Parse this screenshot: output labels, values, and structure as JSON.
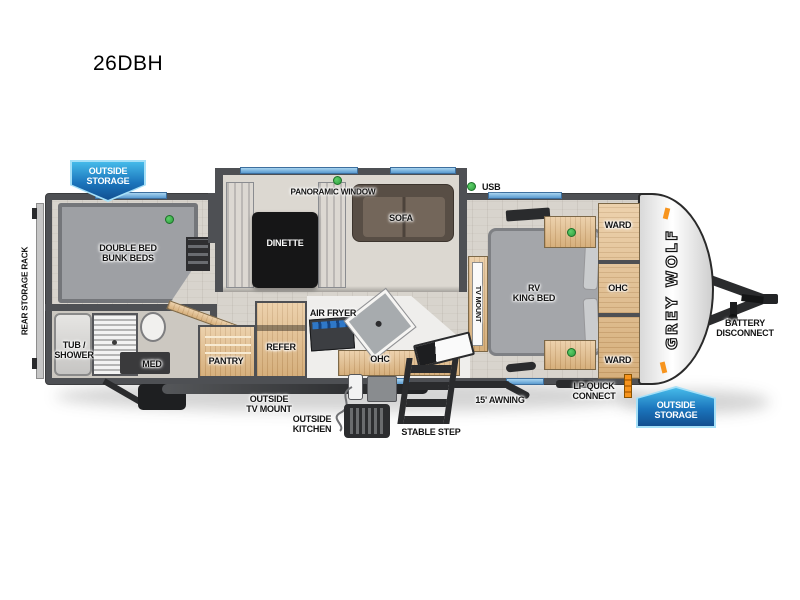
{
  "title": "26DBH",
  "brand": "GREY WOLF",
  "legend": {
    "usb": "USB"
  },
  "exterior": {
    "rear_storage_rack": "REAR STORAGE RACK",
    "outside_storage_rear": "OUTSIDE\nSTORAGE",
    "outside_storage_front": "OUTSIDE\nSTORAGE",
    "battery_disconnect": "BATTERY\nDISCONNECT",
    "outside_tv_mount": "OUTSIDE\nTV MOUNT",
    "outside_kitchen": "OUTSIDE\nKITCHEN",
    "stable_step": "STABLE STEP",
    "awning": "15' AWNING",
    "lp_quick_connect": "LP QUICK\nCONNECT"
  },
  "rooms": {
    "bunk_beds": "DOUBLE BED\nBUNK BEDS",
    "tub_shower": "TUB /\nSHOWER",
    "med": "MED",
    "pantry": "PANTRY",
    "refer": "REFER",
    "dinette": "DINETTE",
    "panoramic_window": "PANORAMIC WINDOW",
    "sofa": "SOFA",
    "air_fryer": "AIR FRYER",
    "ohc_kitchen": "OHC",
    "tv_mount": "TV MOUNT",
    "rv_king_bed": "RV\nKING BED",
    "ward_front": "WARD",
    "ohc_bedroom": "OHC",
    "ward_rear": "WARD"
  },
  "colors": {
    "badge_blue": "#1b75bc",
    "window_blue": "#6fb1dd",
    "indicator_green": "#39b54a",
    "accent_orange": "#f7941d",
    "wall_grey": "#4e5054"
  }
}
